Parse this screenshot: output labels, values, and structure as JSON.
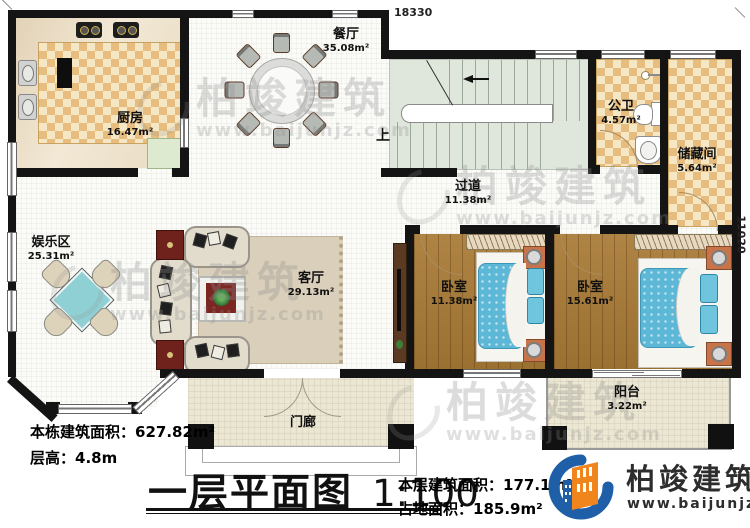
{
  "plan": {
    "dimension_top": "18330",
    "dimension_right": "11020",
    "stairs_up_label": "上"
  },
  "rooms": {
    "kitchen": {
      "name": "厨房",
      "area": "16.47m²"
    },
    "dining": {
      "name": "餐厅",
      "area": "35.08m²"
    },
    "bath": {
      "name": "公卫",
      "area": "4.57m²"
    },
    "storage": {
      "name": "储藏间",
      "area": "5.64m²"
    },
    "hallway": {
      "name": "过道",
      "area": "11.38m²"
    },
    "entertainment": {
      "name": "娱乐区",
      "area": "25.31m²"
    },
    "living": {
      "name": "客厅",
      "area": "29.13m²"
    },
    "bedroom1": {
      "name": "卧室",
      "area": "11.38m²"
    },
    "bedroom2": {
      "name": "卧室",
      "area": "15.61m²"
    },
    "balcony": {
      "name": "阳台",
      "area": "3.22m²"
    },
    "porch": {
      "name": "门廊"
    }
  },
  "info": {
    "building_area_label": "本栋建筑面积：",
    "building_area_value": "627.82m²",
    "floor_height_label": "层高：",
    "floor_height_value": "4.8m",
    "floor_area_label": "本层建筑面积：",
    "floor_area_value": "177.1m²",
    "footprint_label": "占地面积：",
    "footprint_value": "185.9m²"
  },
  "title_block": {
    "title": "一层平面图",
    "scale": "1:100"
  },
  "brand": {
    "name": "柏竣建筑",
    "url": "www.baijunjz.com"
  },
  "watermark": {
    "text": "柏竣建筑",
    "url": "www.baijunjz.com"
  },
  "colors": {
    "wall": "#141414",
    "brand_blue": "#1e5fa8",
    "brand_orange": "#f0851e",
    "bed_blue": "#5cb8d6",
    "checker_dark": "#e7bd7f",
    "wood": "#a87a35",
    "stair_green": "#dfe6dc"
  }
}
